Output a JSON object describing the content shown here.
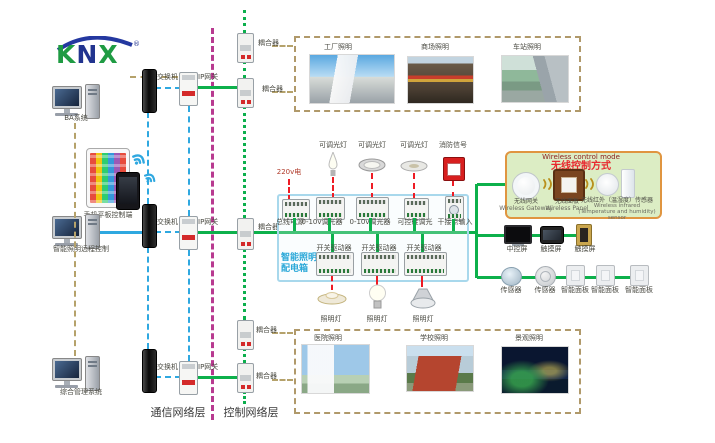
{
  "logo": {
    "k": "K",
    "n": "N",
    "x": "X",
    "reg": "®"
  },
  "left_column": {
    "ba_computer_label": "BA系统",
    "mobile_label": "手机平板控制端",
    "lighting_pc_label": "智能照明远程控制",
    "management_pc_label": "综合管理系统"
  },
  "network": {
    "switch_label": "交换机",
    "gateway_label": "IP网关",
    "coupler_label": "耦合器",
    "comm_layer": "通信网络层",
    "control_layer": "控制网络层"
  },
  "distribution_box": {
    "name_line1": "智能照明",
    "name_line2": "配电箱",
    "power_input": "220v电",
    "top_lamp_labels": [
      "可调光灯",
      "可调光灯",
      "可调光灯",
      "消防信号"
    ],
    "row1_modules": [
      "总线电源",
      "0-10v调光器",
      "0-10v调光器",
      "可控硅调光",
      "干接点输入"
    ],
    "row2_modules": [
      "开关驱动器",
      "开关驱动器",
      "开关驱动器"
    ],
    "bottom_lamp_labels": [
      "照明灯",
      "照明灯",
      "照明灯"
    ]
  },
  "wireless_box": {
    "title_en": "Wireless control mode",
    "title_zh": "无线控制方式",
    "items": [
      {
        "zh": "无线网关",
        "en": "Wireless Gateway"
      },
      {
        "zh": "无线面板",
        "en": "Wireless Panel"
      },
      {
        "zh": "无线红外（温湿度）传感器",
        "en": "Wireless infrared (Temperature and humidity) sensor"
      }
    ]
  },
  "control_devices": {
    "screens": [
      "中控屏",
      "触摸屏",
      "触摸屏"
    ],
    "sensors_panels": [
      "传感器",
      "传感器",
      "智能面板",
      "智能面板",
      "智能面板"
    ]
  },
  "applications": {
    "top": [
      "工厂照明",
      "商场照明",
      "车站照明"
    ],
    "bottom": [
      "医院照明",
      "学校照明",
      "景观照明"
    ]
  },
  "colors": {
    "bus_green": "#0db04b",
    "lan_blue": "#2fa8e0",
    "layer_magenta": "#b83a90",
    "link_tan": "#b5a26b",
    "power_red": "#ee1c25",
    "dist_box_blue": "#a8d8ec",
    "wireless_border": "#e09540",
    "wireless_bg": "#dcedc4"
  }
}
